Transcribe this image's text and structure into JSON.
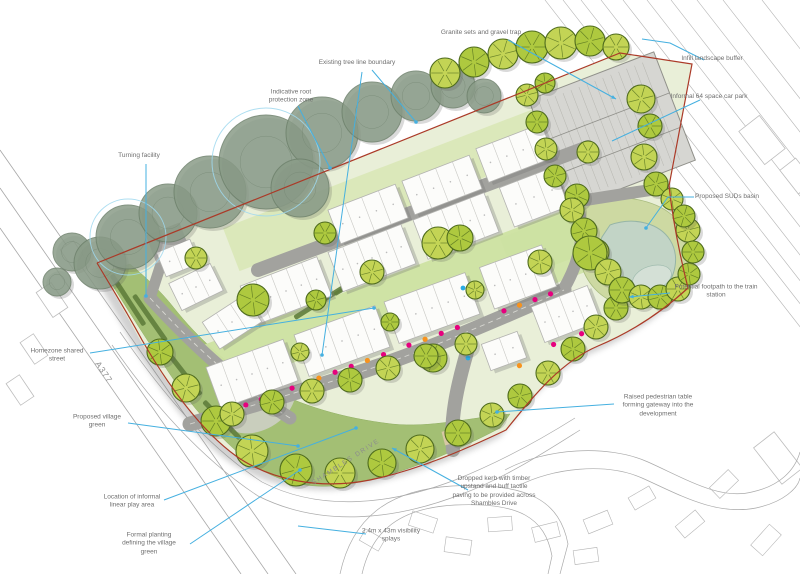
{
  "drawing": {
    "title": "Residential development landscape masterplan sketch",
    "colors": {
      "leader": "#45b0e0",
      "boundary": "#ab3a28",
      "tree_bright": "#aec93f",
      "tree_bright_alt": "#c3d455",
      "tree_bright_stroke": "#4e6b1d",
      "tree_existing": "#8a9c88",
      "tree_existing_stroke": "#6e816c",
      "road": "#a2a29e",
      "road_dash": "#d8d8d2",
      "green_open": "#a3bf74",
      "garden_light": "#dbe8ba",
      "garden_mid": "#cde2a2",
      "site_base": "#e9efd8",
      "parking_surface": "#d6d6d2",
      "basin_green": "#cdd9a2",
      "pond": "#c2d4c6",
      "pond_inner": "#d4e0d6",
      "house": "#fcfcfa",
      "house_stroke": "#b3b3b0",
      "hedge": "#5f7d3c",
      "paving_buff": "#d8c8a4",
      "dot_magenta": "#e6007e",
      "dot_orange": "#f7931e",
      "dot_blue": "#29abe2",
      "label_text": "#6f6f6f",
      "context_line": "#b2b2b2",
      "shadow": "#7d7d7d"
    },
    "road_labels": {
      "a377": {
        "text": "A377",
        "x": 104,
        "y": 372,
        "rotate": 56
      },
      "shambles": {
        "text": "SHAMBLES DRIVE",
        "x": 346,
        "y": 462,
        "rotate": -33
      }
    },
    "annotations": [
      {
        "id": "granite-sets-gravel-trap",
        "lines": [
          "Granite sets and gravel trap"
        ],
        "x": 481,
        "y": 33,
        "leaders": [
          {
            "pts": [
              [
                508,
                40
              ],
              [
                616,
                99
              ]
            ],
            "arrow": true
          }
        ]
      },
      {
        "id": "infill-landscape-buffer",
        "lines": [
          "Infill landscape buffer"
        ],
        "x": 712,
        "y": 59,
        "leaders": [
          {
            "pts": [
              [
                704,
                60
              ],
              [
                670,
                43
              ],
              [
                642,
                39
              ]
            ]
          }
        ]
      },
      {
        "id": "existing-tree-line-boundary",
        "lines": [
          "Existing tree line boundary"
        ],
        "x": 357,
        "y": 63,
        "leaders": [
          {
            "pts": [
              [
                372,
                70
              ],
              [
                416,
                122
              ]
            ],
            "dot": true
          },
          {
            "pts": [
              [
                362,
                72
              ],
              [
                322,
                355
              ]
            ],
            "dot": true
          }
        ]
      },
      {
        "id": "indicative-root-protection-zone",
        "lines": [
          "Indicative root",
          "protection zone"
        ],
        "x": 291,
        "y": 97,
        "leaders": [
          {
            "pts": [
              [
                298,
                106
              ],
              [
                330,
                168
              ]
            ],
            "dot": true
          }
        ]
      },
      {
        "id": "informal-car-park",
        "lines": [
          "Informal 64 space car park"
        ],
        "x": 709,
        "y": 97,
        "leaders": [
          {
            "pts": [
              [
                700,
                100
              ],
              [
                612,
                141
              ]
            ]
          }
        ]
      },
      {
        "id": "turning-facility",
        "lines": [
          "Turning facility"
        ],
        "x": 139,
        "y": 156,
        "leaders": [
          {
            "pts": [
              [
                146,
                164
              ],
              [
                146,
                296
              ]
            ],
            "dot": true
          }
        ]
      },
      {
        "id": "proposed-suds-basin",
        "lines": [
          "Proposed SUDs basin"
        ],
        "x": 727,
        "y": 197,
        "leaders": [
          {
            "pts": [
              [
                694,
                197
              ],
              [
                668,
                197
              ],
              [
                646,
                228
              ]
            ],
            "dot": true
          }
        ]
      },
      {
        "id": "potential-footpath-train-station",
        "lines": [
          "Potential footpath to the train",
          "station"
        ],
        "x": 716,
        "y": 292,
        "leaders": [
          {
            "pts": [
              [
                670,
                293
              ],
              [
                629,
                297
              ]
            ],
            "arrow": true
          }
        ]
      },
      {
        "id": "homezone-shared-street",
        "lines": [
          "Homezone shared",
          "street"
        ],
        "x": 57,
        "y": 356,
        "leaders": [
          {
            "pts": [
              [
                90,
                353
              ],
              [
                374,
                308
              ]
            ],
            "dot": true
          }
        ]
      },
      {
        "id": "proposed-village-green",
        "lines": [
          "Proposed village",
          "green"
        ],
        "x": 97,
        "y": 422,
        "leaders": [
          {
            "pts": [
              [
                128,
                423
              ],
              [
                298,
                446
              ]
            ],
            "dot": true
          }
        ]
      },
      {
        "id": "raised-pedestrian-table",
        "lines": [
          "Raised pedestrian table",
          "forming gateway into the",
          "development"
        ],
        "x": 658,
        "y": 406,
        "leaders": [
          {
            "pts": [
              [
                614,
                404
              ],
              [
                497,
                412
              ]
            ],
            "dot": true
          }
        ]
      },
      {
        "id": "informal-linear-play-area",
        "lines": [
          "Location of informal",
          "linear play area"
        ],
        "x": 132,
        "y": 502,
        "leaders": [
          {
            "pts": [
              [
                164,
                500
              ],
              [
                356,
                428
              ]
            ],
            "dot": true
          }
        ]
      },
      {
        "id": "dropped-kerb-tactile-paving",
        "lines": [
          "Dropped kerb with timber",
          "upstand and buff tactile",
          "paving to be provided across",
          "Shambles Drive"
        ],
        "x": 494,
        "y": 492,
        "leaders": [
          {
            "pts": [
              [
                468,
                490
              ],
              [
                392,
                448
              ]
            ],
            "arrow": true
          }
        ]
      },
      {
        "id": "formal-planting-village-green",
        "lines": [
          "Formal planting",
          "defining the village",
          "green"
        ],
        "x": 149,
        "y": 544,
        "leaders": [
          {
            "pts": [
              [
                190,
                544
              ],
              [
                300,
                470
              ]
            ],
            "dot": true
          }
        ]
      },
      {
        "id": "visibility-splays",
        "lines": [
          "2.4m x 43m visibility",
          "splays"
        ],
        "x": 391,
        "y": 536,
        "leaders": [
          {
            "pts": [
              [
                366,
                534
              ],
              [
                298,
                526
              ]
            ]
          }
        ]
      }
    ]
  }
}
